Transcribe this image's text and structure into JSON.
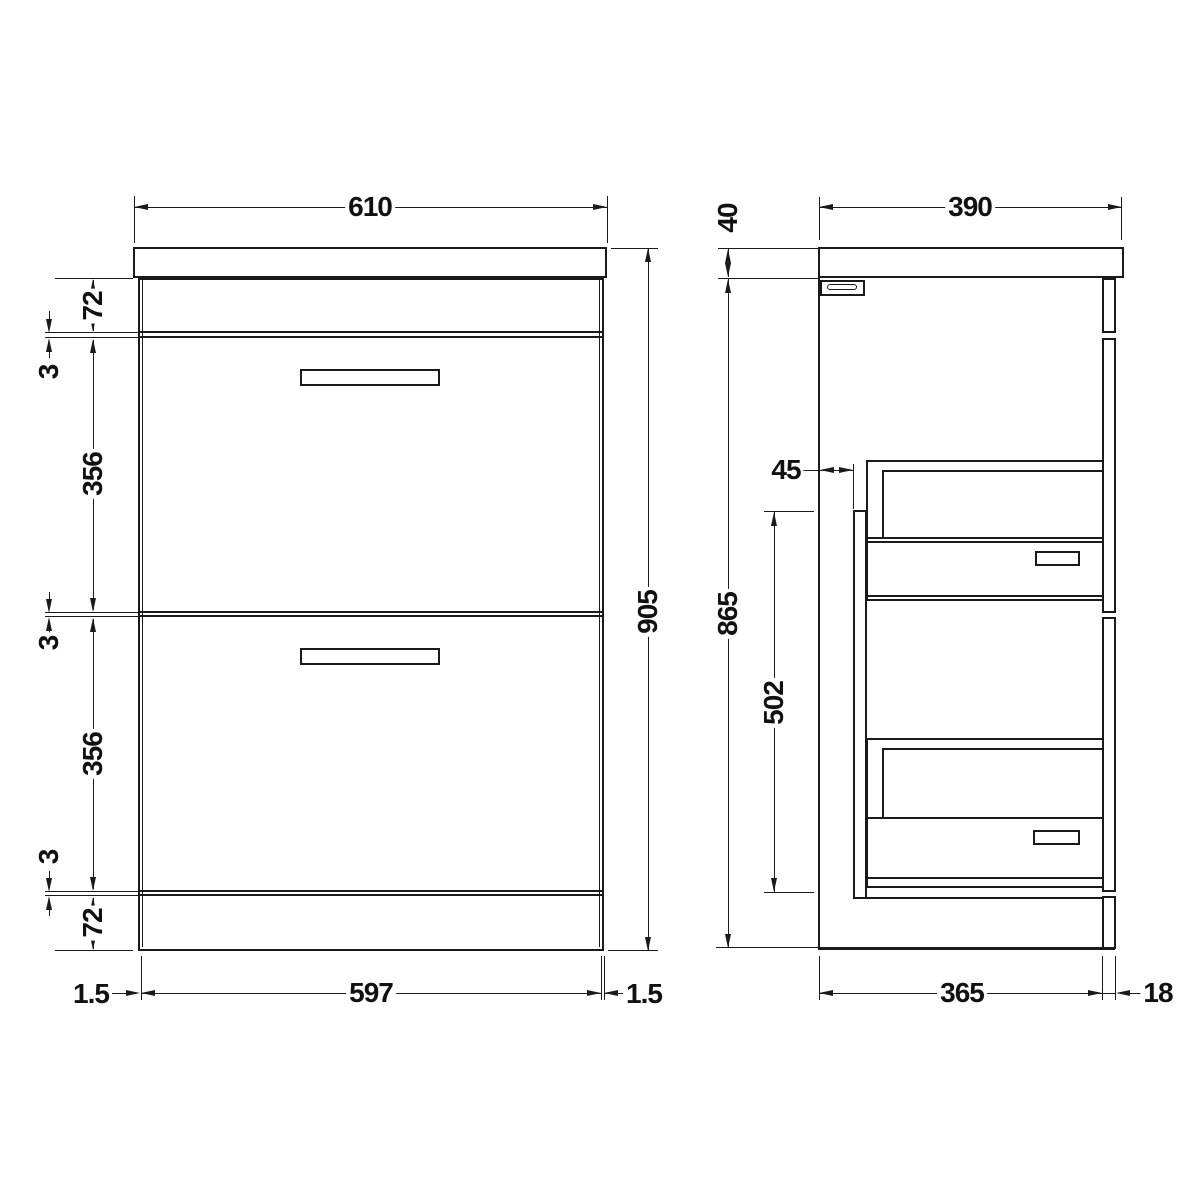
{
  "front_view": {
    "width": "610",
    "overall_height": "905",
    "top_rail_height": "72",
    "gap_top": "3",
    "drawer1_height": "356",
    "gap_middle": "3",
    "drawer2_height": "356",
    "gap_bottom": "3",
    "plinth_height": "72",
    "side_gap_left": "1.5",
    "drawer_front_width": "597",
    "side_gap_right": "1.5"
  },
  "side_view": {
    "depth": "390",
    "worktop_thickness": "40",
    "runner_setback": "45",
    "carcass_height": "865",
    "internal_height": "502",
    "carcass_depth": "365",
    "front_panel_thickness": "18"
  },
  "colors": {
    "line": "#1a1a1a",
    "background": "#ffffff"
  }
}
